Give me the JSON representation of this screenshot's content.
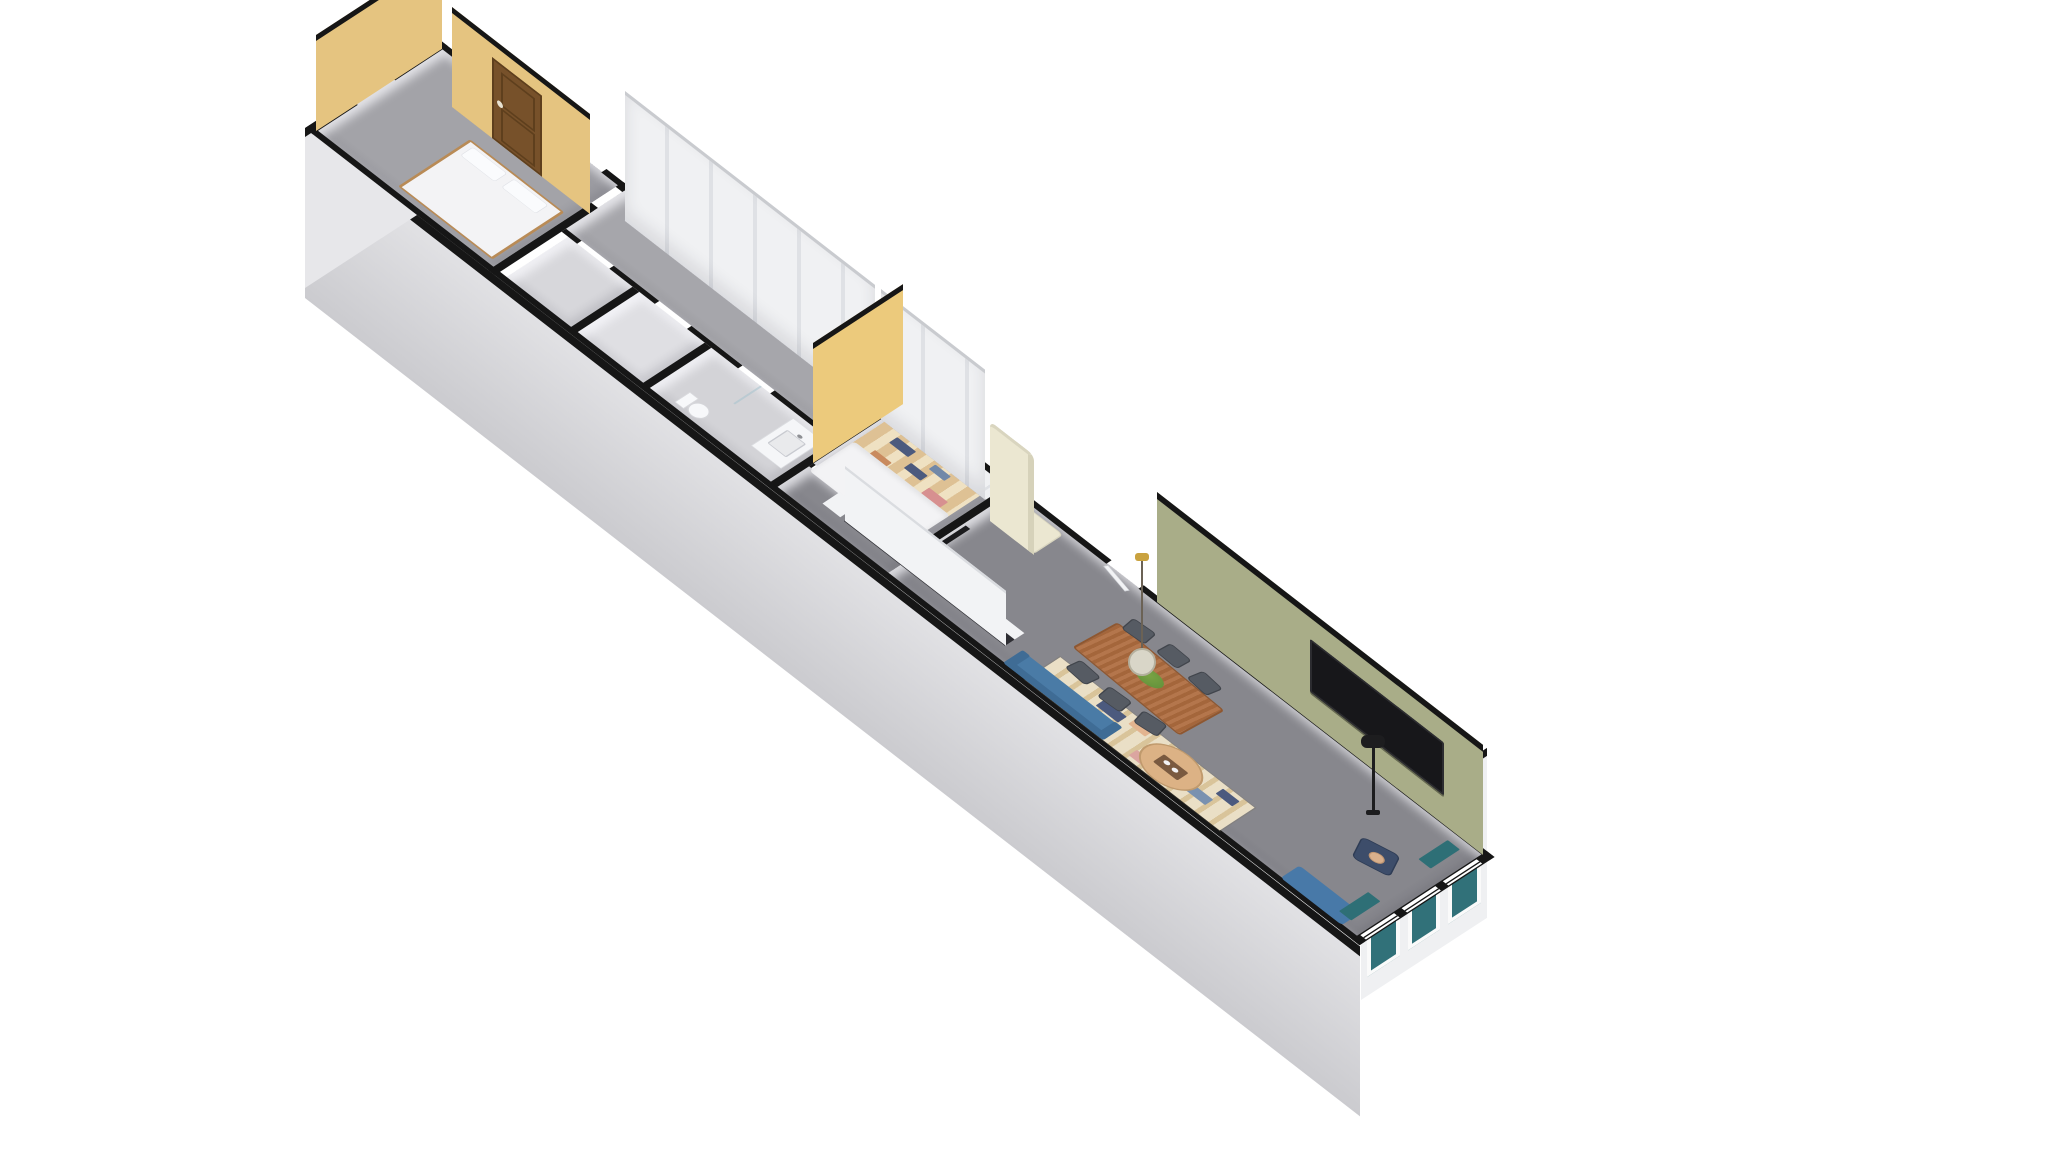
{
  "scene": {
    "type": "3d-floorplan",
    "projection": "axonometric",
    "background": "#ffffff"
  },
  "colors": {
    "bg": "#ffffff",
    "wall": "#161616",
    "accent-yellow": "#e5c480",
    "accent-yellow-2": "#ecca7c",
    "accent-green": "#a9ad88",
    "door-brown": "#77512a",
    "door-brown-dark": "#5e3f1d",
    "door-white": "#f2f3f5",
    "floor-bedroom-1": "#a3a3a8",
    "floor-hall": "#9b9ba1",
    "floor-corridor": "#a6a6ab",
    "floor-room-a": "#d7d7db",
    "floor-room-b": "#dfdfe3",
    "floor-bathroom": "#d3d3d7",
    "floor-bedroom-2": "#a0a0a6",
    "floor-living": "#87878d",
    "closet-white": "#f0f1f3",
    "closet-line": "#dfe1e5",
    "bed-white": "#f3f3f5",
    "bed-frame": "#b98b56",
    "porcelain": "#fafbfd",
    "quilt-tan": "#dec194",
    "quilt-cream": "#efe1c2",
    "quilt-navy": "#4c5a7e",
    "quilt-pink": "#d79090",
    "quilt-rust": "#c98a5e",
    "quilt-blue": "#7188a8",
    "counter-white": "#f2f3f5",
    "counter-dark": "#2e2e33",
    "sink-steel": "#c9ccd0",
    "sink-inner": "#e9eaec",
    "fridge-cream": "#ebe7d1",
    "fridge-shadow": "#d6d2ba",
    "table-wood": "#b06f42",
    "table-wood-dark": "#8f5730",
    "chair-gray": "#565b63",
    "plant-green": "#7aa344",
    "plant-green-dark": "#5f8f3a",
    "tv-black": "#17171a",
    "rug-cream": "#eadfc6",
    "rug-tan": "#d9c49a",
    "rug-peach": "#e3b48f",
    "rug-navy": "#4c5a7e",
    "rug-blue": "#7991b0",
    "rug-pink": "#dba5a0",
    "rug-orange": "#d0905e",
    "sofa-blue": "#4a7ba6",
    "sofa-blue-dark": "#3f6c95",
    "chaise-blue": "#4879a8",
    "coffee-wood": "#dcb285",
    "tray-brown": "#7a5a40",
    "lamp-black": "#1d1d1f",
    "armchair-navy": "#3d4d6a",
    "skin-tan": "#d9b08c",
    "curtain-teal": "#2e6f76",
    "window-glass": "#317179",
    "mirror-blue": "#cfe0e4",
    "toilet-edge": "#d5d6da",
    "cord": "#6b6255",
    "pendant-shade": "#d9d6c8",
    "pendant-gold": "#c9a23f",
    "wood-step": "#a97f4f"
  },
  "rooms": [
    {
      "id": "bedroom-west",
      "accent_wall_color": "#e5c480",
      "contents": [
        "double-bed",
        "brown-panel-door",
        "west-window"
      ]
    },
    {
      "id": "entry-hall",
      "contents": [
        "front-door",
        "doorway-to-corridor"
      ]
    },
    {
      "id": "corridor",
      "contents": [
        "closet-row"
      ]
    },
    {
      "id": "storage-room-a",
      "contents": []
    },
    {
      "id": "storage-room-b",
      "contents": []
    },
    {
      "id": "bathroom",
      "contents": [
        "vanity-sink",
        "toilet",
        "shower-screen"
      ]
    },
    {
      "id": "bedroom-middle",
      "accent_wall_color": "#ecca7c",
      "contents": [
        "bed-with-striped-quilt",
        "wardrobe-row",
        "coat-rack"
      ]
    },
    {
      "id": "kitchen",
      "contents": [
        "counter-with-sink",
        "tall-cabinet",
        "retro-fridge"
      ]
    },
    {
      "id": "living-dining",
      "accent_wall_color": "#a9ad88",
      "contents": [
        "dining-table",
        "dining-chairs-x6",
        "pendant-lamp",
        "plant-centerpiece",
        "wall-mounted-tv",
        "striped-rug",
        "blue-sofa",
        "round-coffee-table",
        "blue-chaise",
        "armchair-with-occupant",
        "floor-lamp",
        "curtained-windows-x3"
      ]
    }
  ]
}
